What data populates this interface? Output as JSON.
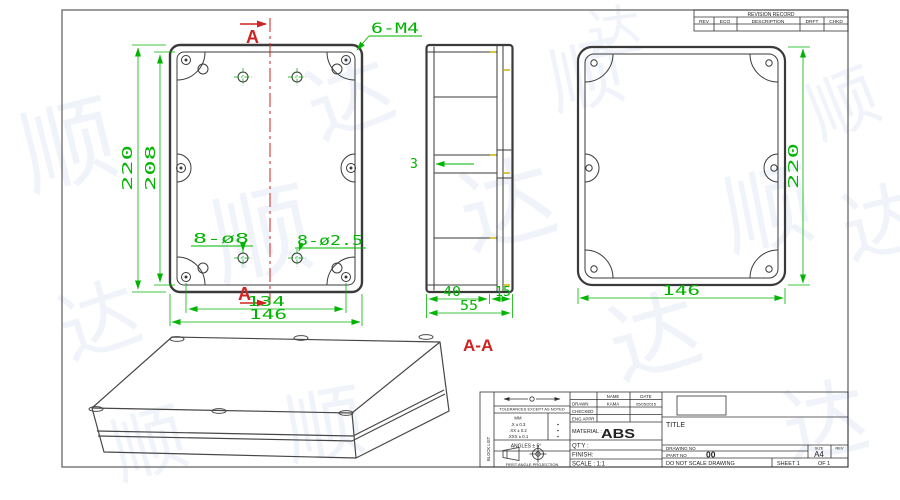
{
  "drawing": {
    "view_bottom": {
      "dim_height_outer": "220",
      "dim_height_inner": "208",
      "dim_width_inner": "134",
      "dim_width_outer": "146",
      "label_thread_holes": "6-M4",
      "label_large_holes": "8-ø8",
      "label_small_holes": "8-ø2.5",
      "section_letter_top": "A",
      "section_letter_bottom": "A"
    },
    "view_side": {
      "dim_wall_thickness": "3",
      "dim_base_depth": "40",
      "dim_lid_depth": "15",
      "dim_total_depth": "55"
    },
    "view_lid": {
      "dim_width": "146",
      "dim_height": "220"
    },
    "section_view_title": "A-A"
  },
  "revision_table": {
    "title": "REVISION RECORD",
    "col_rev": "REV",
    "col_eco": "ECO",
    "col_description": "DESCRIPTION",
    "col_drft": "DRFT",
    "col_chkd": "CHKD"
  },
  "title_block": {
    "side_label": "BLOCK LIST",
    "tolerances_header": "TOLERANCES EXCEPT AS NOTED",
    "tol_unit": "MM",
    "tol_row1": ".X ± 0.3",
    "tol_row2": ".XX ± 0.2",
    "tol_row3": ".XXX ± 0.1",
    "angles": "ANGLES ± 5°",
    "projection_caption": "FIRST ANGLE PROJECTION",
    "col_name": "NAME",
    "col_date": "DATE",
    "row_drawn": "DRAWN",
    "drawn_name": "KAMA",
    "drawn_date": "05/05/2015",
    "row_checked": "CHECKED",
    "row_eng_appr": "ENG APPR",
    "material_label": "MATERIAL :",
    "material_value": "ABS",
    "qty_label": "QT'Y :",
    "finish_label": "FINISH:",
    "scale_label": "SCALE : 1:1",
    "title_label": "TITLE",
    "drawing_no_label": "DRAWING NO",
    "part_no_label": "/PART NO",
    "part_no_value": "00",
    "size_label": "SIZE",
    "size_value": "A4",
    "rev_label": "REV",
    "do_not_scale": "DO NOT SCALE DRAWING",
    "sheet_label": "SHEET 1",
    "of_label": "OF 1"
  },
  "watermark": {
    "char1": "顺",
    "char2": "达"
  },
  "colors": {
    "dimension": "#00b400",
    "section": "#cf2222",
    "line": "#3a3a3a",
    "watermark": "#8fa8d8"
  }
}
